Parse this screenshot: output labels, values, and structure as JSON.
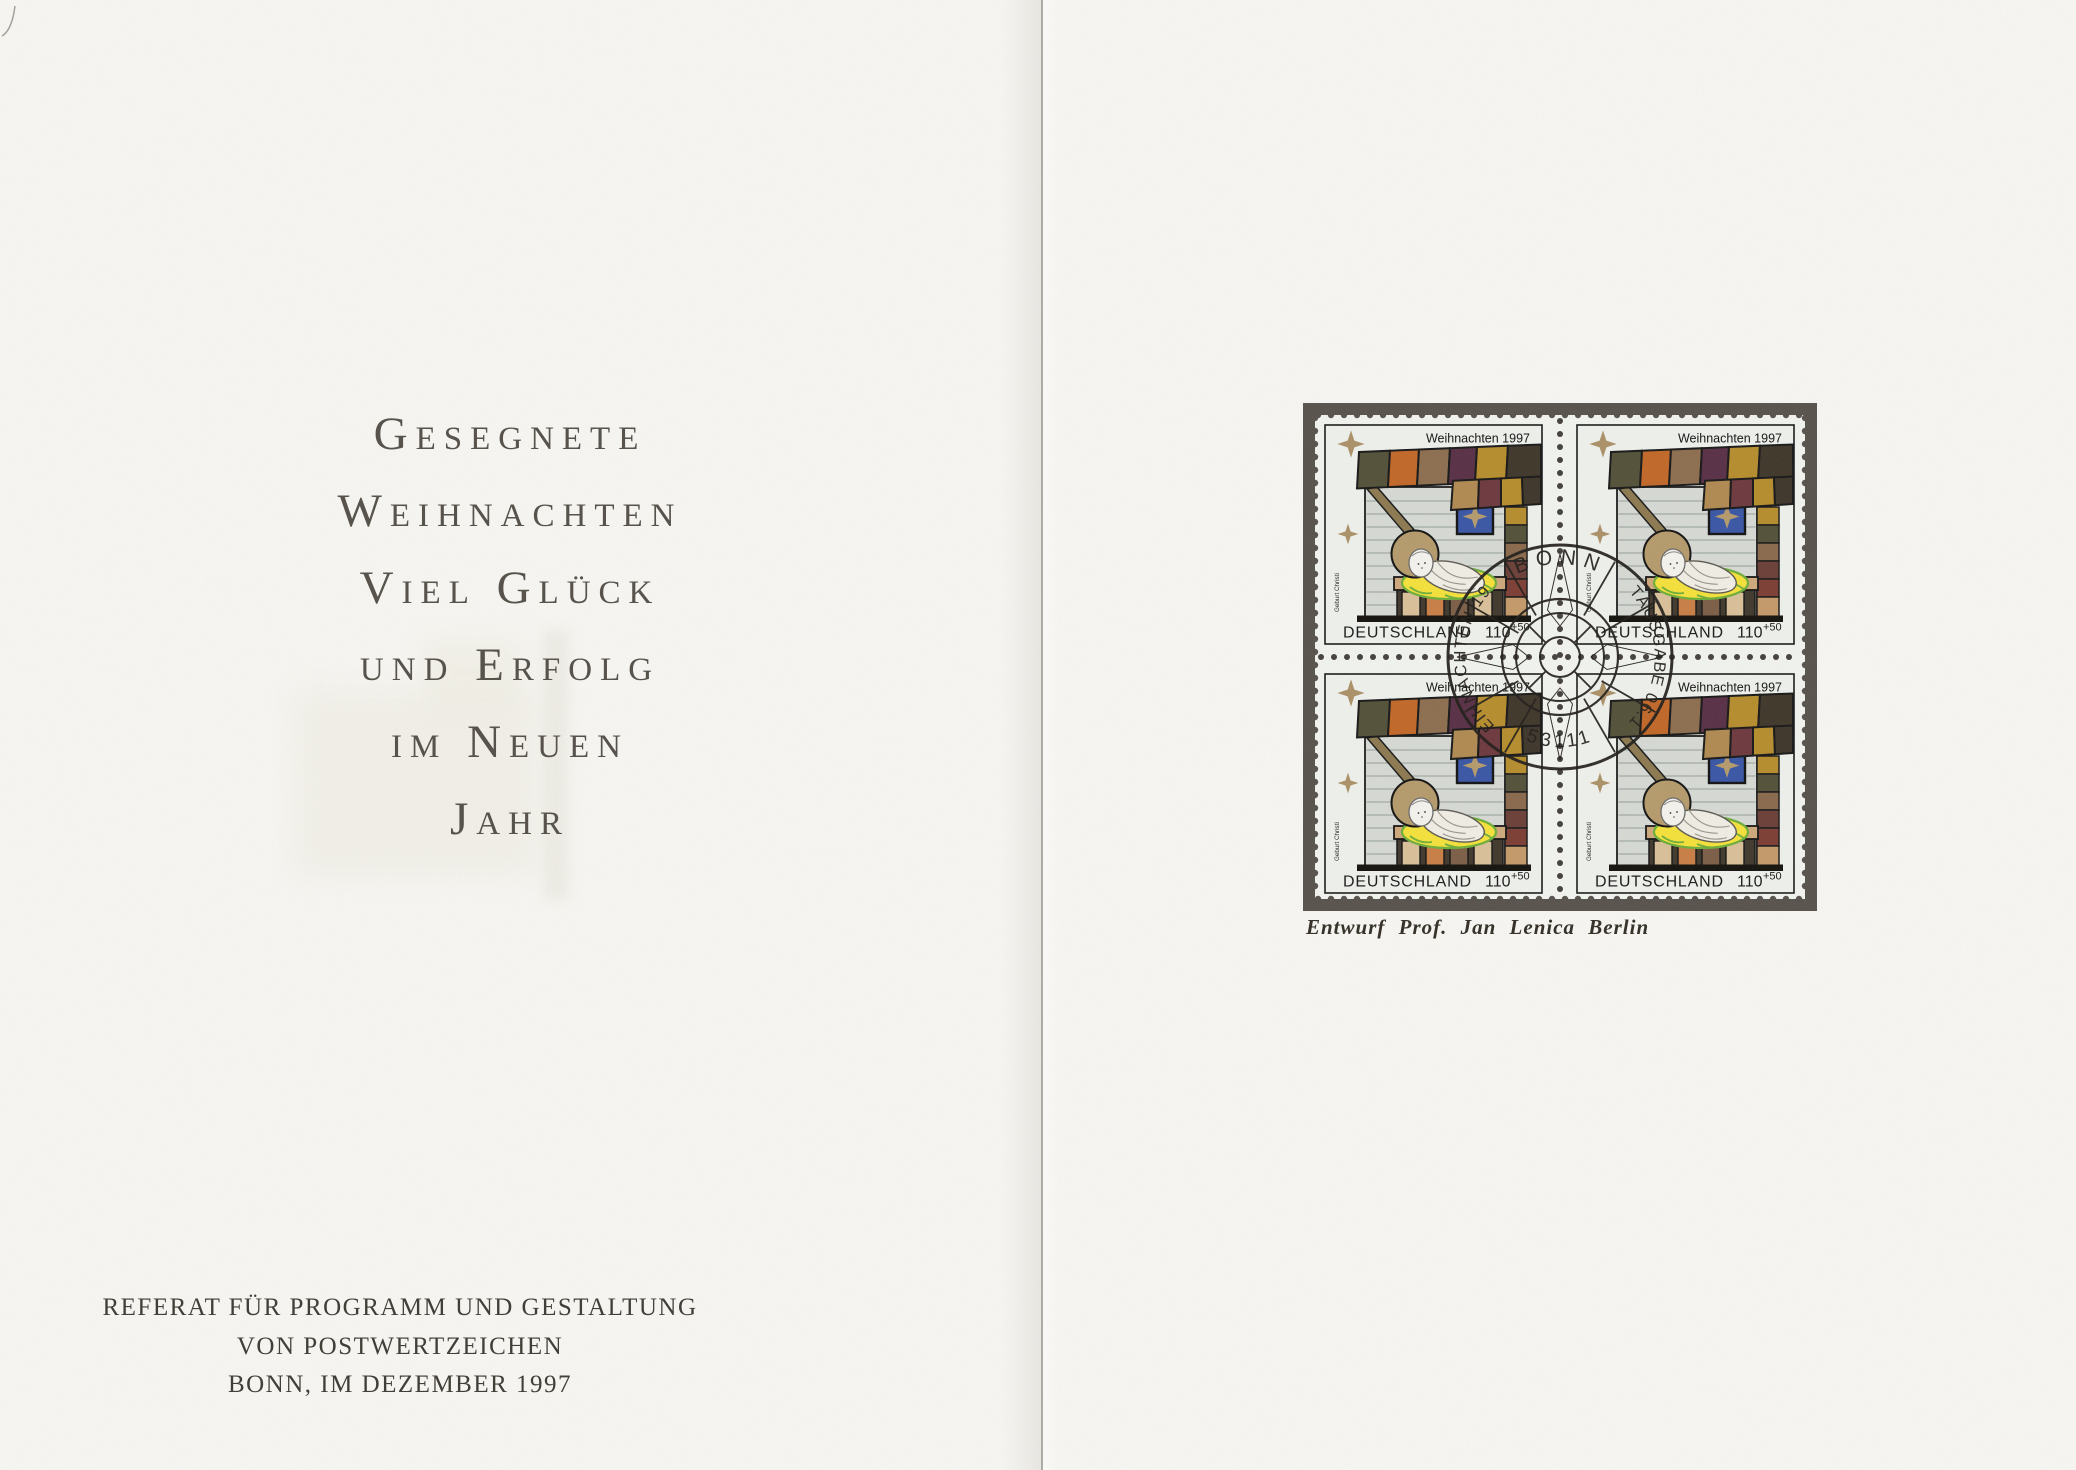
{
  "card": {
    "left_page": {
      "greeting_lines": [
        "Gesegnete",
        "Weihnachten",
        "Viel Glück",
        "und Erfolg",
        "im Neuen",
        "Jahr"
      ],
      "imprint_lines": [
        "REFERAT FÜR PROGRAMM UND GESTALTUNG",
        "VON POSTWERTZEICHEN",
        "BONN, IM DEZEMBER 1997"
      ]
    },
    "right_page": {
      "stamp": {
        "header": "Weihnachten 1997",
        "country": "DEUTSCHLAND",
        "denomination": "110",
        "surcharge": "+50",
        "side_label": "Geburt Christi",
        "count": 4
      },
      "postmark": {
        "top": "BONN",
        "left_arc": "WEIHNACHTEN 1997",
        "right_arc": "ERSTAUSGABE 06.11.97",
        "bottom": "53111"
      },
      "caption": "Entwurf Prof. Jan Lenica Berlin"
    }
  },
  "colors": {
    "paper": "#f7f6f2",
    "greeting_ink": "#55514a",
    "imprint_ink": "#3f3b35",
    "stamp_mat": "#59534e",
    "stamp_paper": "#f1f3ef",
    "gold_star": "#ab9168",
    "window_blue": "#3b57a5",
    "hay_yellow": "#f4e13c",
    "cancel_ink": "#23201d"
  }
}
